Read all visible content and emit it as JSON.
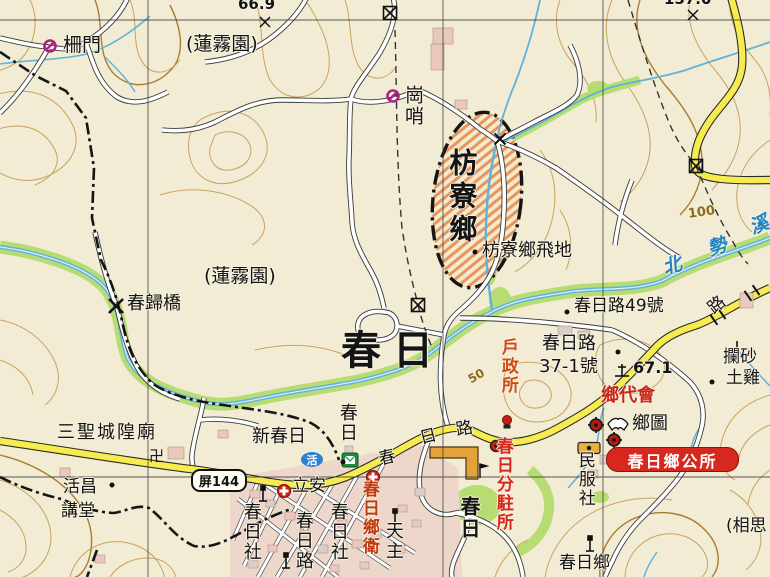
{
  "labels": {
    "spot_669": "66.9",
    "spot_1570": "157.0",
    "zhamen": "柵門",
    "lianwu_north": "(蓮霧園)",
    "gangshao": "崗哨",
    "fangliao_township": "枋寮鄉",
    "fangliao_enclave": "枋寮鄉飛地",
    "lianwu_south": "(蓮霧園)",
    "chungui_bridge": "春歸橋",
    "chunri_town": "春日",
    "contour_100": "100",
    "contour_50": "50",
    "river_chars": [
      "北",
      "勢",
      "溪"
    ],
    "addr_49": "春日路49號",
    "addr_37_line1": "春日路",
    "addr_37_line2": "37-1號",
    "spot_671": "67.1",
    "lansha": "攔砂",
    "tuji": "土雞",
    "road_lu_upper": "路",
    "huzhengsuo": "戶政所",
    "xiangdaihui": "鄉代會",
    "xiangtu": "鄉圖",
    "gongsuo": "春日鄉公所",
    "minfushe": "民服社",
    "chunri_xiang": "春日鄉",
    "xiangsi": "(相思",
    "sansheng_temple": "三聖城隍廟",
    "swastika": "卍",
    "shield": "屏144",
    "huochang_line1": "活昌",
    "huochang_line2": "講堂",
    "xin_chunri": "新春日",
    "chunri_vert_river": "春日",
    "road_chun": "春",
    "road_ri": "日",
    "road_lu": "路",
    "lian_an": "立安",
    "huo": "活",
    "tianzhu": "天主",
    "chunri_she_w": "春日社",
    "chunri_lu_v": "春日路",
    "chunri_she_e": "春日社",
    "weishengsuo": "春日鄉衛",
    "fenzhusuo": "春日分駐所",
    "chunri_vert_park": "春日"
  },
  "colors": {
    "accent_red": "#d6281e",
    "road_yellow": "#f6ec4f",
    "water_blue": "#5fb3da",
    "veg_green": "#b7dc72",
    "enclave_hatch": "#e07b35",
    "boundary_black": "#1a1a1a",
    "label_red": "#c8271a",
    "label_orange_red": "#d04a12",
    "contour_brown": "#c8a25c",
    "gate_purple": "#a82384"
  }
}
